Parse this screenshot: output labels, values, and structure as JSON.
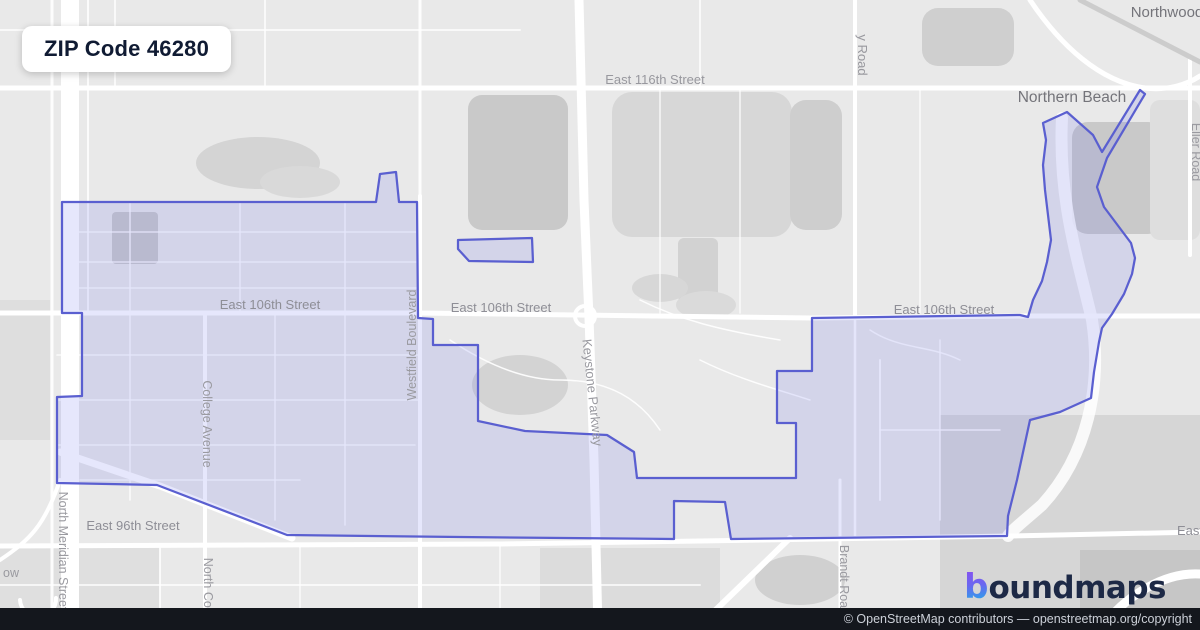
{
  "title": "ZIP Code 46280",
  "branding": {
    "logo_mark": "b",
    "logo_text": "oundmaps"
  },
  "attribution": {
    "text": "© OpenStreetMap contributors — openstreetmap.org/copyright"
  },
  "map": {
    "background": "#e9e9e9",
    "boundary": {
      "stroke": "#5a5fd0",
      "fill": "rgba(104,110,235,0.17)",
      "stroke_width": 2.25,
      "main_points": "62,202 376,202 380,174 396,172 399,202 417,202 418,318 433,319 433,345 478,345 478,421 525,431 607,435 634,452 637,478 796,478 796,423 777,423 777,371 812,371 812,318 1020,315 1028,317 1033,300 1042,281 1047,262 1051,240 1048,215 1045,190 1043,165 1046,140 1043,123 1067,112 1093,135 1102,152 1140,90 1145,94 1107,158 1097,187 1104,207 1119,227 1131,243 1135,258 1132,274 1124,294 1112,314 1102,328 1099,342 1094,372 1091,398 1060,412 1030,420 1017,480 1008,516 1007,536 731,539 725,502 674,501 674,539 460,537 287,535 157,485 57,483 57,397 82,396 82,313 62,313",
      "satellite_points": "458,240 532,238 533,262 469,261 458,249"
    },
    "patches": [
      {
        "t": "e",
        "cx": 258,
        "cy": 163,
        "rx": 62,
        "ry": 26,
        "f": "#d4d4d4"
      },
      {
        "t": "e",
        "cx": 300,
        "cy": 182,
        "rx": 40,
        "ry": 16,
        "f": "#d9d9d9"
      },
      {
        "t": "r",
        "x": 112,
        "y": 212,
        "w": 46,
        "h": 52,
        "rx": 4,
        "f": "#c9c9c9"
      },
      {
        "t": "r",
        "x": 468,
        "y": 95,
        "w": 100,
        "h": 135,
        "rx": 14,
        "f": "#c9c9c9"
      },
      {
        "t": "r",
        "x": 612,
        "y": 92,
        "w": 180,
        "h": 145,
        "rx": 20,
        "f": "#d7d7d7"
      },
      {
        "t": "r",
        "x": 790,
        "y": 100,
        "w": 52,
        "h": 130,
        "rx": 16,
        "f": "#cecece"
      },
      {
        "t": "r",
        "x": 922,
        "y": 8,
        "w": 92,
        "h": 58,
        "rx": 16,
        "f": "#cfcfcf"
      },
      {
        "t": "r",
        "x": 1072,
        "y": 122,
        "w": 92,
        "h": 112,
        "rx": 16,
        "f": "#c9c9c9"
      },
      {
        "t": "r",
        "x": 1150,
        "y": 100,
        "w": 50,
        "h": 140,
        "rx": 10,
        "f": "#dedede"
      },
      {
        "t": "r",
        "x": 678,
        "y": 238,
        "w": 40,
        "h": 64,
        "rx": 6,
        "f": "#d2d2d2"
      },
      {
        "t": "e",
        "cx": 660,
        "cy": 288,
        "rx": 28,
        "ry": 14,
        "f": "#d7d7d7"
      },
      {
        "t": "e",
        "cx": 520,
        "cy": 385,
        "rx": 48,
        "ry": 30,
        "f": "#d3d3d3"
      },
      {
        "t": "e",
        "cx": 706,
        "cy": 305,
        "rx": 30,
        "ry": 14,
        "f": "#dadada"
      },
      {
        "t": "r",
        "x": 940,
        "y": 415,
        "w": 260,
        "h": 215,
        "rx": 0,
        "f": "#d6d6d6"
      },
      {
        "t": "r",
        "x": 1080,
        "y": 550,
        "w": 120,
        "h": 80,
        "rx": 0,
        "f": "#c6c6c6"
      },
      {
        "t": "r",
        "x": 540,
        "y": 548,
        "w": 180,
        "h": 82,
        "rx": 0,
        "f": "#dcdcdc"
      },
      {
        "t": "e",
        "cx": 800,
        "cy": 580,
        "rx": 45,
        "ry": 25,
        "f": "#d0d0d0"
      },
      {
        "t": "r",
        "x": 0,
        "y": 300,
        "w": 50,
        "h": 140,
        "rx": 0,
        "f": "#dedede"
      },
      {
        "t": "r",
        "x": 0,
        "y": 548,
        "w": 160,
        "h": 82,
        "rx": 0,
        "f": "#dfdfdf"
      }
    ],
    "roads": [
      {
        "d": "M0,30 H520",
        "w": 2,
        "o": 0.7
      },
      {
        "d": "M115,0 V88",
        "w": 2,
        "o": 0.7
      },
      {
        "d": "M265,0 V88",
        "w": 2,
        "o": 0.7
      },
      {
        "d": "M700,0 V88",
        "w": 2,
        "o": 0.7
      },
      {
        "d": "M920,88 V313",
        "w": 1.5,
        "o": 0.8
      },
      {
        "d": "M660,88 V313",
        "w": 1.5,
        "o": 0.8
      },
      {
        "d": "M740,88 V313",
        "w": 1.5,
        "o": 0.8
      },
      {
        "d": "M130,202 V313",
        "w": 1.6,
        "o": 0.8
      },
      {
        "d": "M240,202 V313",
        "w": 1.6,
        "o": 0.8
      },
      {
        "d": "M345,202 V313",
        "w": 1.6,
        "o": 0.8
      },
      {
        "d": "M62,232 H418",
        "w": 1.6,
        "o": 0.8
      },
      {
        "d": "M62,262 H418",
        "w": 1.6,
        "o": 0.8
      },
      {
        "d": "M62,288 H418",
        "w": 1.6,
        "o": 0.8
      },
      {
        "d": "M130,313 V500",
        "w": 1.6,
        "o": 0.8
      },
      {
        "d": "M275,313 V520",
        "w": 1.6,
        "o": 0.8
      },
      {
        "d": "M345,313 V525",
        "w": 1.6,
        "o": 0.8
      },
      {
        "d": "M57,355 H420",
        "w": 1.6,
        "o": 0.8
      },
      {
        "d": "M57,400 H420",
        "w": 1.6,
        "o": 0.8
      },
      {
        "d": "M57,445 H415",
        "w": 1.6,
        "o": 0.8
      },
      {
        "d": "M80,480 H300",
        "w": 1.6,
        "o": 0.8
      },
      {
        "d": "M450,340 C480,360 520,380 560,380 C610,380 640,400 660,430",
        "w": 1.5,
        "o": 0.9
      },
      {
        "d": "M640,300 C680,320 720,330 780,340",
        "w": 1.5,
        "o": 0.9
      },
      {
        "d": "M700,360 C740,380 780,390 810,400",
        "w": 1.5,
        "o": 0.9
      },
      {
        "d": "M880,360 V500",
        "w": 2,
        "o": 0.85
      },
      {
        "d": "M940,340 V520",
        "w": 1.5,
        "o": 0.85
      },
      {
        "d": "M880,430 H1000",
        "w": 1.5,
        "o": 0.85
      },
      {
        "d": "M870,330 C900,350 930,345 960,360",
        "w": 1.5,
        "o": 0.85
      },
      {
        "d": "M0,585 H700",
        "w": 2,
        "o": 0.7
      },
      {
        "d": "M160,546 V630",
        "w": 2,
        "o": 0.8
      },
      {
        "d": "M300,546 V630",
        "w": 1.5,
        "o": 0.8
      },
      {
        "d": "M500,546 V630",
        "w": 1.5,
        "o": 0.8
      },
      {
        "d": "M1062,118 C1058,200 1078,260 1092,320 C1102,385 1088,455 1042,505 C1025,520 1012,530 1008,536",
        "w": 12,
        "o": 0.85
      },
      {
        "d": "M88,0 V313",
        "w": 2,
        "o": 0.8
      },
      {
        "d": "M52,0 V630",
        "w": 3,
        "o": 0.9
      },
      {
        "d": "M70,0 V630",
        "w": 18
      },
      {
        "d": "M0,88 H1200",
        "w": 5
      },
      {
        "d": "M0,313 L418,313 L812,318 L1030,316 L1200,316",
        "w": 5
      },
      {
        "d": "M0,546 L500,544 L700,541 L1010,536 L1200,532",
        "w": 5
      },
      {
        "d": "M205,313 V630",
        "w": 4
      },
      {
        "d": "M420,196 V630",
        "w": 4
      },
      {
        "d": "M420,0 V196",
        "w": 3,
        "o": 0.9
      },
      {
        "d": "M579,0 L584,200 L589,318 L594,460 L598,630",
        "w": 9
      },
      {
        "d": "M855,0 V318",
        "w": 4
      },
      {
        "d": "M855,318 V536",
        "w": 2.5,
        "o": 0.9
      },
      {
        "d": "M840,480 V630",
        "w": 3
      },
      {
        "d": "M1190,60 V255",
        "w": 4
      },
      {
        "d": "M1030,0 C1060,45 1100,82 1145,88 C1168,91 1188,84 1200,76",
        "w": 5
      },
      {
        "d": "M1080,0 L1200,62",
        "w": 5,
        "c": "#c9c9c9",
        "o": 0.9
      },
      {
        "d": "M695,630 L790,538",
        "w": 6
      },
      {
        "d": "M1100,630 C1125,595 1165,572 1200,574",
        "w": 9
      },
      {
        "d": "M60,452 L160,486 L292,538",
        "w": 7
      },
      {
        "d": "M0,560 C30,540 45,525 60,480",
        "w": 4
      },
      {
        "d": "M20,600 a18,18 0 1 0 36,-2",
        "w": 4
      },
      {
        "d": "M575,316 a10,10 0 1 0 20,0 a10,10 0 1 0 -20,0",
        "w": 4
      }
    ],
    "labels": [
      {
        "text": "East 116th Street",
        "x": 655,
        "y": 84,
        "s": 13,
        "c": "#98989e",
        "r": 0
      },
      {
        "text": "y Road",
        "x": 858,
        "y": 55,
        "s": 13,
        "c": "#98989e",
        "r": 90
      },
      {
        "text": "Northwood",
        "x": 1167,
        "y": 17,
        "s": 15,
        "c": "#74747a",
        "r": 0
      },
      {
        "text": "Northern Beach",
        "x": 1072,
        "y": 102,
        "s": 15.5,
        "c": "#74747a",
        "r": 0
      },
      {
        "text": "Eller Road",
        "x": 1192,
        "y": 152,
        "s": 12.5,
        "c": "#9a9aa0",
        "r": 90
      },
      {
        "text": "East 106th Street",
        "x": 270,
        "y": 309,
        "s": 13,
        "c": "#8e8e96",
        "r": 0
      },
      {
        "text": "East 106th Street",
        "x": 501,
        "y": 312,
        "s": 13,
        "c": "#8e8e96",
        "r": 0
      },
      {
        "text": "East 106th Street",
        "x": 944,
        "y": 314,
        "s": 13,
        "c": "#8e8e96",
        "r": 0
      },
      {
        "text": "Westfield Boulevard",
        "x": 416,
        "y": 345,
        "s": 12.5,
        "c": "#9a9aa0",
        "r": -90
      },
      {
        "text": "Keystone Parkway",
        "x": 588,
        "y": 393,
        "s": 13,
        "c": "#9a9aa0",
        "r": 84
      },
      {
        "text": "College Avenue",
        "x": 203,
        "y": 424,
        "s": 12.5,
        "c": "#9a9aa0",
        "r": 90
      },
      {
        "text": "North Meridian Street",
        "x": 59,
        "y": 551,
        "s": 12.5,
        "c": "#9a9aa0",
        "r": 90
      },
      {
        "text": "East 96th Street",
        "x": 133,
        "y": 530,
        "s": 13,
        "c": "#8e8e96",
        "r": 0
      },
      {
        "text": "North College",
        "x": 204,
        "y": 596,
        "s": 12.5,
        "c": "#9a9aa0",
        "r": 90
      },
      {
        "text": "Brandt Road",
        "x": 840,
        "y": 580,
        "s": 12.5,
        "c": "#9a9aa0",
        "r": 90
      },
      {
        "text": "East",
        "x": 1190,
        "y": 535,
        "s": 13,
        "c": "#8e8e96",
        "r": 0
      },
      {
        "text": "ow",
        "x": 11,
        "y": 577,
        "s": 12.5,
        "c": "#9a9aa0",
        "r": 0
      }
    ]
  }
}
